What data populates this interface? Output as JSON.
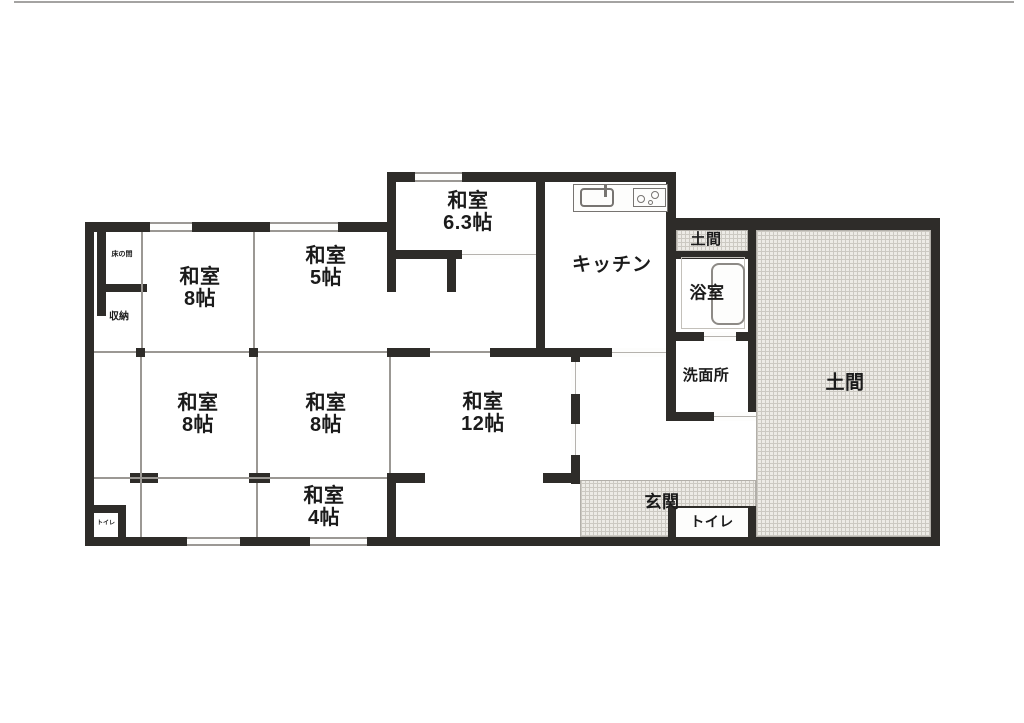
{
  "diagram": {
    "kind": "japanese-house-floor-plan",
    "rooms": {
      "washitsu_top_left": {
        "label": "和室",
        "size": "8帖"
      },
      "washitsu_5": {
        "label": "和室",
        "size": "5帖"
      },
      "washitsu_6_3": {
        "label": "和室",
        "size": "6.3帖"
      },
      "kitchen": {
        "label": "キッチン"
      },
      "doma_small": {
        "label": "土間"
      },
      "bathroom": {
        "label": "浴室"
      },
      "washroom": {
        "label": "洗面所"
      },
      "doma_large": {
        "label": "土間"
      },
      "washitsu_mid_left": {
        "label": "和室",
        "size": "8帖"
      },
      "washitsu_mid_center": {
        "label": "和室",
        "size": "8帖"
      },
      "washitsu_12": {
        "label": "和室",
        "size": "12帖"
      },
      "washitsu_4": {
        "label": "和室",
        "size": "4帖"
      },
      "genkan": {
        "label": "玄関"
      },
      "toilet_entrance": {
        "label": "トイレ"
      },
      "storage": {
        "label": "収納"
      },
      "tokonoma": {
        "label": "床の間"
      },
      "toilet_corner": {
        "label": "トイレ"
      }
    },
    "icons": {
      "kitchen_sink": "kitchen-sink-icon",
      "stove": "stove-burner-icon",
      "bathtub": "bathtub-icon"
    },
    "colors": {
      "wall": "#2e2c29",
      "doma_fill": "#edebe6",
      "doma_grid": "#ccc9c2",
      "thin_line": "#9b9894",
      "text": "#1b1b1b",
      "background": "#ffffff"
    }
  }
}
